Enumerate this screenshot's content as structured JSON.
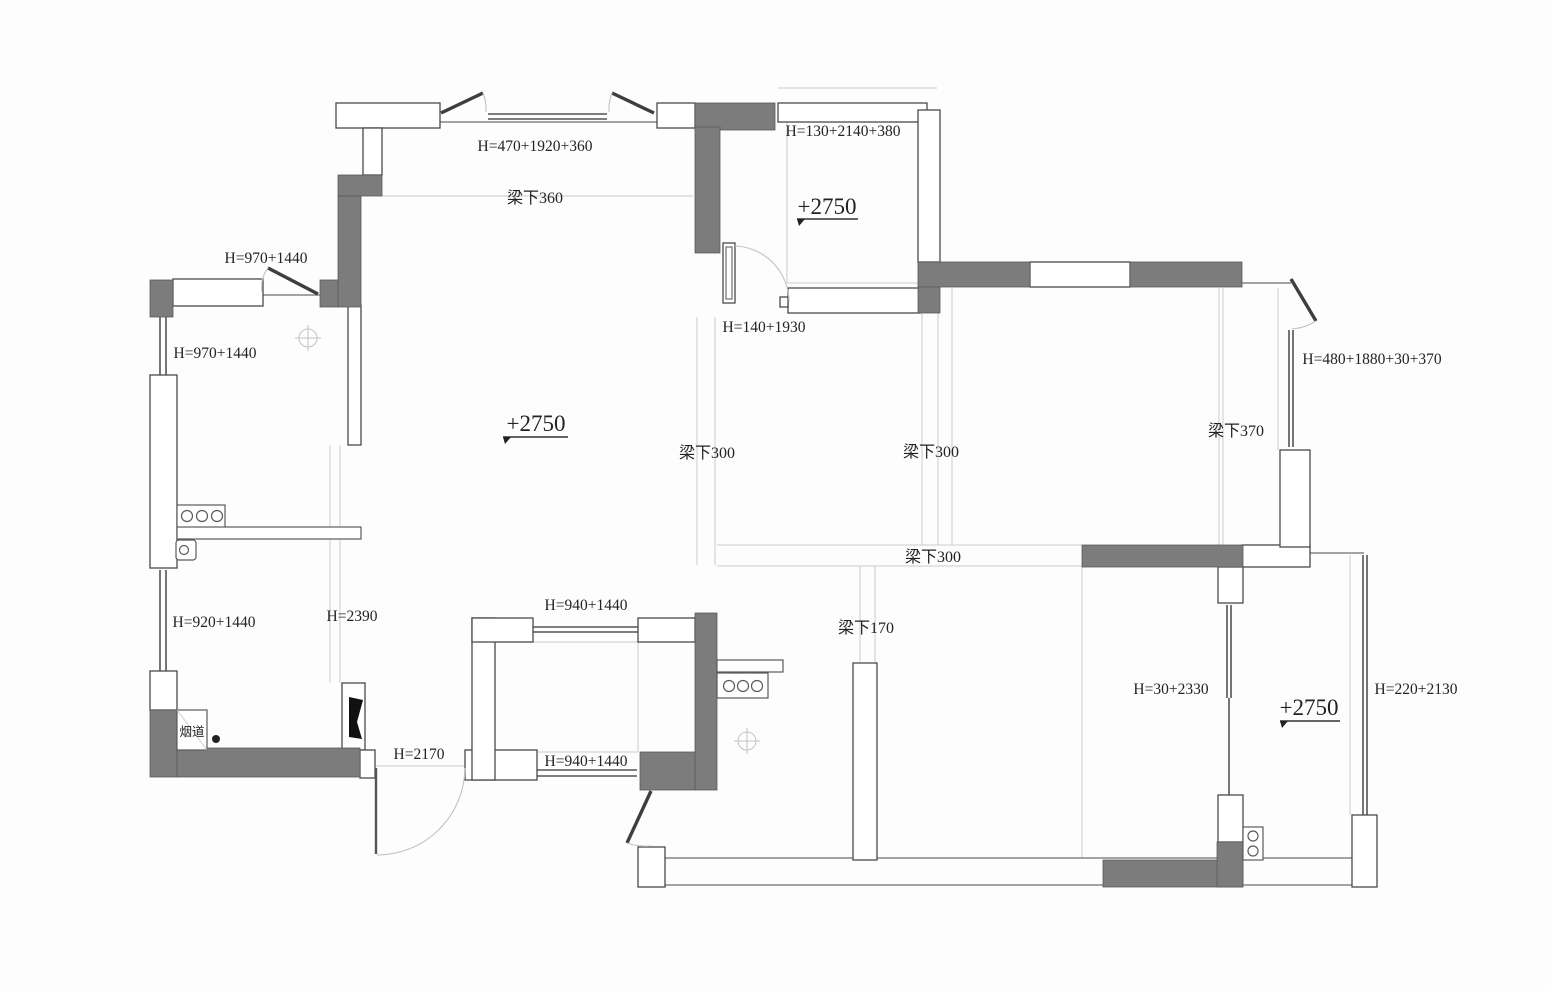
{
  "drawing": {
    "type": "residential-floor-plan",
    "colors": {
      "wall_fill": "#7c7c7c",
      "wall_outline": "#4a4a4a",
      "reference_line": "#cccccc",
      "text": "#222222",
      "background": "#fdfdfd"
    }
  },
  "labels": {
    "win_top_living": "H=470+1920+360",
    "beam_360": "梁下360",
    "win_bed1_top": "H=130+2140+380",
    "lvl_bed1": "+2750",
    "win_kitchen_top": "H=970+1440",
    "win_kitchen_left": "H=970+1440",
    "lvl_living": "+2750",
    "sill_entry": "H=140+1930",
    "beam_300_left": "梁下300",
    "beam_300_right": "梁下300",
    "beam_370": "梁下370",
    "win_master_right": "H=480+1880+30+370",
    "beam_300_lower": "梁下300",
    "win_utility_left": "H=920+1440",
    "open_2390": "H=2390",
    "win_store_top": "H=940+1440",
    "beam_170": "梁下170",
    "win_br2_left": "H=30+2330",
    "lvl_br2": "+2750",
    "win_br2_right": "H=220+2130",
    "flue": "烟道",
    "door_2170": "H=2170",
    "win_store_bottom": "H=940+1440"
  }
}
